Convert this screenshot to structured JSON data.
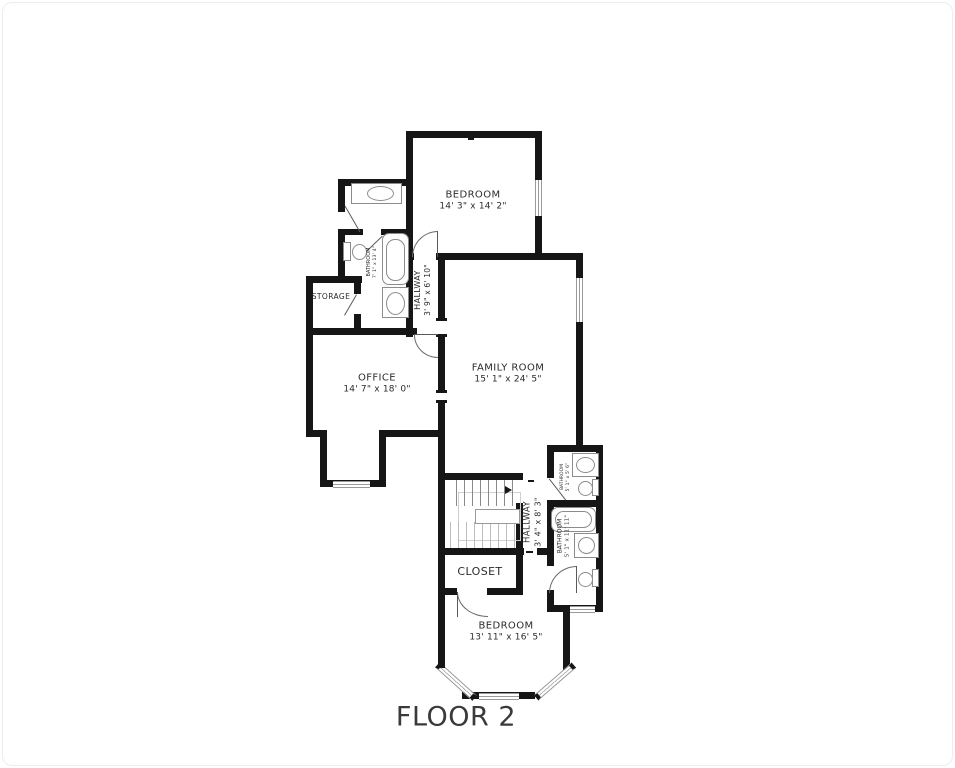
{
  "floor_title": "FLOOR 2",
  "colors": {
    "wall": "#161616",
    "label_text": "#2b2b2b",
    "fixture_outline": "#8c8c8c"
  },
  "rooms": {
    "bedroom_top": {
      "name": "BEDROOM",
      "dims": "14' 3\" x 14' 2\""
    },
    "hallway_top": {
      "name": "HALLWAY",
      "dims": "3' 9\" x 6' 10\""
    },
    "bathroom_top": {
      "name": "BATHROOM",
      "dims": "7' 1\" x 13' 4\""
    },
    "storage": {
      "name": "STORAGE"
    },
    "office": {
      "name": "OFFICE",
      "dims": "14' 7\" x 18' 0\""
    },
    "family_room": {
      "name": "FAMILY ROOM",
      "dims": "15' 1\" x 24' 5\""
    },
    "hallway_bottom": {
      "name": "HALLWAY",
      "dims": "3' 4\" x 8' 3\""
    },
    "bathroom_small": {
      "name": "BATHROOM",
      "dims": "5' 1\" x 5' 6\""
    },
    "bathroom_bottom": {
      "name": "BATHROOM",
      "dims": "5' 1\" x 11' 11\""
    },
    "closet": {
      "name": "CLOSET"
    },
    "bedroom_bottom": {
      "name": "BEDROOM",
      "dims": "13' 11\" x 16' 5\""
    }
  }
}
